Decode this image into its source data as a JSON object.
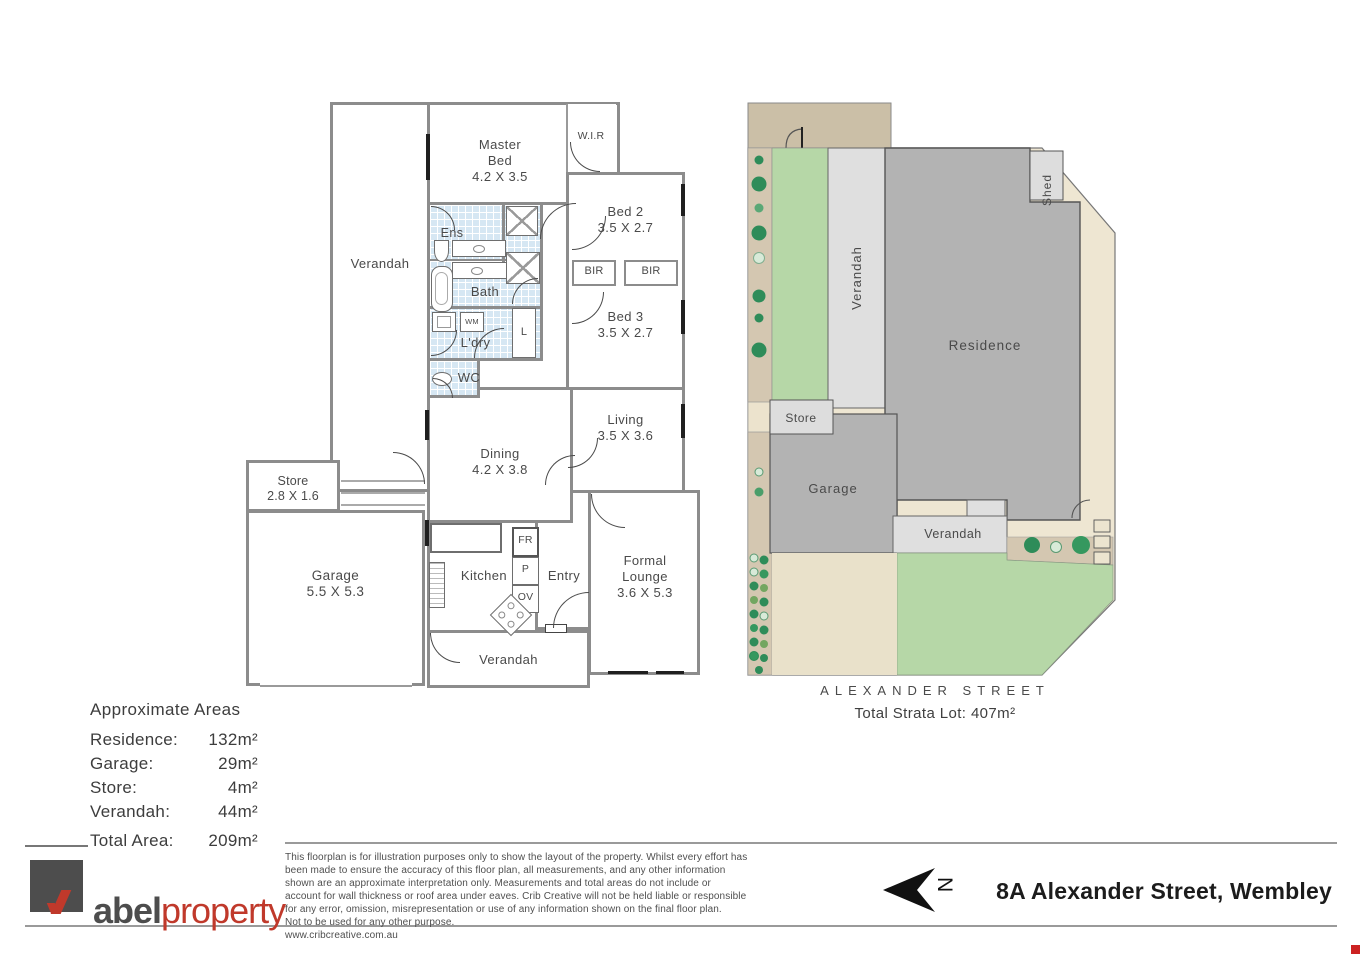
{
  "floorplan": {
    "rooms": {
      "verandah_left": {
        "name": "Verandah"
      },
      "master_bed": {
        "name": "Master Bed",
        "dims": "4.2 X 3.5"
      },
      "wir": {
        "name": "W.I.R"
      },
      "bed2": {
        "name": "Bed 2",
        "dims": "3.5 X 2.7"
      },
      "bir1": {
        "name": "BIR"
      },
      "bir2": {
        "name": "BIR"
      },
      "bed3": {
        "name": "Bed 3",
        "dims": "3.5 X 2.7"
      },
      "ens": {
        "name": "Ens"
      },
      "bath": {
        "name": "Bath"
      },
      "ldry": {
        "name": "L'dry"
      },
      "wm": {
        "name": "WM"
      },
      "linen": {
        "name": "L"
      },
      "wc": {
        "name": "WC"
      },
      "dining": {
        "name": "Dining",
        "dims": "4.2 X 3.8"
      },
      "living": {
        "name": "Living",
        "dims": "3.5 X 3.6"
      },
      "store": {
        "name": "Store",
        "dims": "2.8 X 1.6"
      },
      "garage": {
        "name": "Garage",
        "dims": "5.5 X 5.3"
      },
      "kitchen": {
        "name": "Kitchen"
      },
      "fr": {
        "name": "FR"
      },
      "p": {
        "name": "P"
      },
      "ov": {
        "name": "OV"
      },
      "entry": {
        "name": "Entry"
      },
      "formal_lounge": {
        "name": "Formal Lounge",
        "dims": "3.6 X 5.3"
      },
      "verandah_bottom": {
        "name": "Verandah"
      }
    }
  },
  "siteplan": {
    "labels": {
      "verandah_side": "Verandah",
      "residence": "Residence",
      "shed": "Shed",
      "store": "Store",
      "garage": "Garage",
      "verandah_front": "Verandah"
    },
    "street": "ALEXANDER STREET",
    "total_lot": "Total Strata Lot: 407m²"
  },
  "areas": {
    "title": "Approximate Areas",
    "rows": [
      {
        "label": "Residence:",
        "value": "132m²"
      },
      {
        "label": "Garage:",
        "value": "29m²"
      },
      {
        "label": "Store:",
        "value": "4m²"
      },
      {
        "label": "Verandah:",
        "value": "44m²"
      }
    ],
    "total_label": "Total Area:",
    "total_value": "209m²"
  },
  "footer": {
    "logo_abel": "abel",
    "logo_property": "property",
    "disclaimer_lines": [
      "This floorplan is for illustration purposes only to show the layout of the property. Whilst every effort has",
      "been made to ensure the accuracy of this floor plan, all measurements, and any other information",
      "shown are an approximate interpretation only. Measurements and total areas do not include or",
      "account for wall thickness or roof area under eaves. Crib Creative will not be held liable or responsible",
      "for any error, omission, misrepresentation or use of any information shown on the final floor plan.",
      "Not to be used for any other purpose.",
      "www.cribcreative.com.au"
    ],
    "address": "8A Alexander Street, Wembley",
    "north_letter": "N"
  },
  "colors": {
    "wall_gray": "#8c8c8c",
    "tile_blue": "#d6e7f3",
    "logo_red": "#c0392b",
    "logo_gray": "#4d4d4d",
    "site_residence": "#b3b3b3",
    "site_verandah": "#dfdfdf",
    "site_lawn": "#b6d7a7",
    "site_lot": "#eee6d2",
    "site_tan": "#d4c7b1",
    "tree_green": "#2e8c59",
    "corner_dot_red": "#cc2222"
  }
}
